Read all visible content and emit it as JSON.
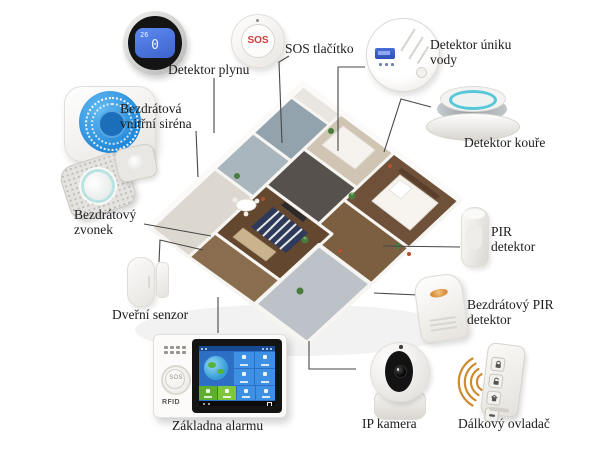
{
  "diagram_title": "Smart home alarm system components",
  "devices": {
    "gas_detector": {
      "label": "Detektor plynu",
      "lcd_temp": "26",
      "lcd_value": "0"
    },
    "sos_button": {
      "label": "SOS tlačítko",
      "button_text": "SOS"
    },
    "water_leak_detector": {
      "label": "Detektor úniku vody"
    },
    "smoke_detector": {
      "label": "Detektor kouře"
    },
    "indoor_siren": {
      "label": "Bezdrátová vnitřní siréna"
    },
    "wireless_doorbell": {
      "label": "Bezdrátový zvonek"
    },
    "door_sensor": {
      "label": "Dveřní senzor"
    },
    "alarm_base": {
      "label": "Základna alarmu",
      "sos_text": "SOS",
      "rfid_text": "RFID"
    },
    "ip_camera": {
      "label": "IP kamera"
    },
    "remote_control": {
      "label": "Dálkový ovladač"
    },
    "pir_detector": {
      "label": "PIR detektor"
    },
    "wireless_pir_detector": {
      "label": "Bezdrátový PIR detektor"
    }
  },
  "colors": {
    "siren_blue": "#1f86d8",
    "lcd_blue": "#3d63cc",
    "sos_red": "#d23b3b",
    "signal_orange": "#cf8a2e",
    "screen_blue": "#2e6fc6",
    "tile_green": "#5fae2e",
    "smoke_ring_teal": "#58c8d8"
  }
}
